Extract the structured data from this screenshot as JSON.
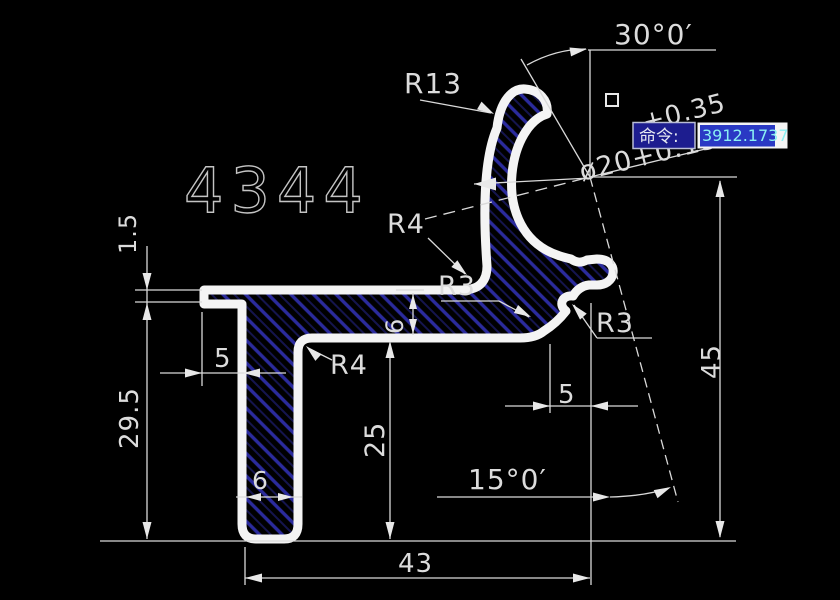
{
  "drawing": {
    "part_number": "4344",
    "radius_labels": {
      "r13": "R13",
      "r4_upper": "R4",
      "r4_lower": "R4",
      "r3_middle": "R3",
      "r3_right": "R3"
    },
    "angle_dims": {
      "top": "30°0′",
      "bottom": "15°0′"
    },
    "diameter_dim": {
      "tol_upper": "+0.35",
      "value": "ø20+0.15"
    },
    "linear_dims": {
      "right_height": "45",
      "right_offset": "5",
      "bottom_width": "43",
      "leg_height": "25",
      "mid_thickness": "6",
      "leg_width": "6",
      "left_offset": "5",
      "tip_thickness": "1.5",
      "left_height": "29.5"
    }
  },
  "command_bar": {
    "label": "命令:",
    "value": "3912.1737"
  },
  "colors": {
    "background": "#000000",
    "dimension_lines": "#d9d9d9",
    "profile_outline": "#f4f4f4",
    "hatch_blue": "#2b2b9d",
    "command_box_blue": "#1d1d8f",
    "selection_highlight": "#2a39c4",
    "selection_text_cyan": "#8af0f2"
  }
}
